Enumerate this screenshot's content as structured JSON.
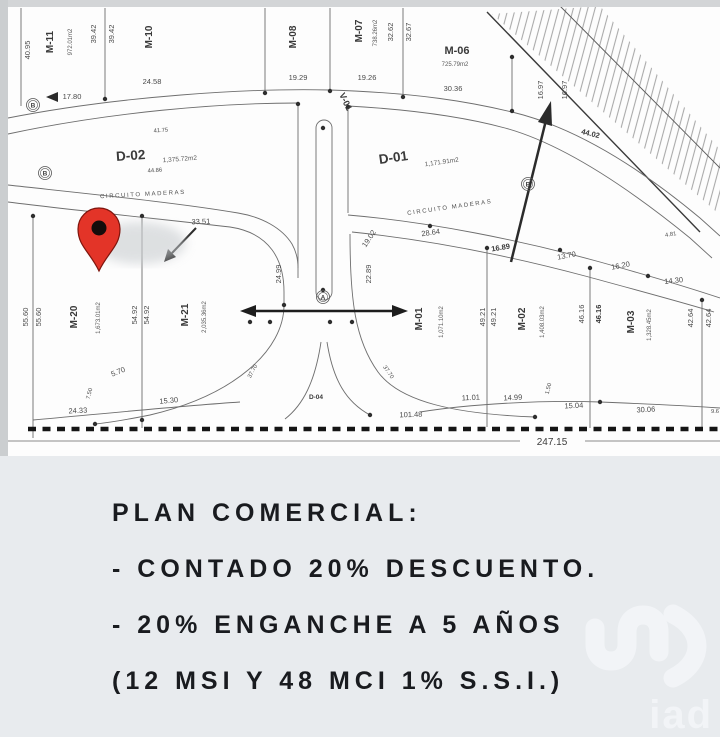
{
  "plan": {
    "street_left": "CIRCUITO MADERAS",
    "street_right": "CIRCUITO MADERAS",
    "bottom_total": "247.15",
    "lots": {
      "m11": {
        "name": "M-11",
        "area": "972.01m2"
      },
      "m10": {
        "name": "M-10"
      },
      "m08": {
        "name": "M-08"
      },
      "m07": {
        "name": "M-07",
        "area": "738.26m2"
      },
      "m06": {
        "name": "M-06",
        "area": "725.79m2"
      },
      "d02": {
        "name": "D-02",
        "area": "1,375.72m2"
      },
      "d01": {
        "name": "D-01",
        "area": "1,171.91m2"
      },
      "v01": {
        "name": "V-01"
      },
      "m20": {
        "name": "M-20",
        "area": "1,673.01m2"
      },
      "m21": {
        "name": "M-21",
        "area": "2,035.36m2"
      },
      "m01": {
        "name": "M-01",
        "area": "1,071.10m2"
      },
      "m02": {
        "name": "M-02",
        "area": "1,408.03m2"
      },
      "m03": {
        "name": "M-03",
        "area": "1,328.45m2"
      },
      "d04": {
        "name": "D-04"
      }
    },
    "markers": {
      "a": "A",
      "b": "B"
    },
    "dims": [
      "40.95",
      "39.42",
      "39.42",
      "24.58",
      "17.80",
      "19.29",
      "19.26",
      "32.62",
      "32.67",
      "30.36",
      "16.97",
      "16.97",
      "44.02",
      "41.75",
      "44.86",
      "33.51",
      "28.64",
      "19.02",
      "16.89",
      "13.70",
      "16.20",
      "14.30",
      "4.81",
      "24.99",
      "22.89",
      "55.60",
      "55.60",
      "54.92",
      "54.92",
      "49.21",
      "49.21",
      "46.16",
      "46.16",
      "42.64",
      "42.64",
      "5.70",
      "7.50",
      "24.33",
      "15.30",
      "37.70",
      "37.70",
      "101.48",
      "11.01",
      "14.99",
      "1.50",
      "15.04",
      "30.06",
      "9.6"
    ],
    "colors": {
      "pin_red": "#e33428",
      "line_gray": "#6e6e6e",
      "panel_bg": "#e8ebee"
    }
  },
  "icons": {
    "pin": "map-pin-icon",
    "north_arrow": "direction-arrow-icon"
  },
  "info_panel": {
    "line1": "PLAN COMERCIAL:",
    "line2": "- CONTADO 20% DESCUENTO.",
    "line3": "- 20% ENGANCHE A 5 AÑOS",
    "line4": "(12 MSI Y 48 MCI 1% S.S.I.)"
  },
  "watermark": {
    "brand": "iad"
  }
}
